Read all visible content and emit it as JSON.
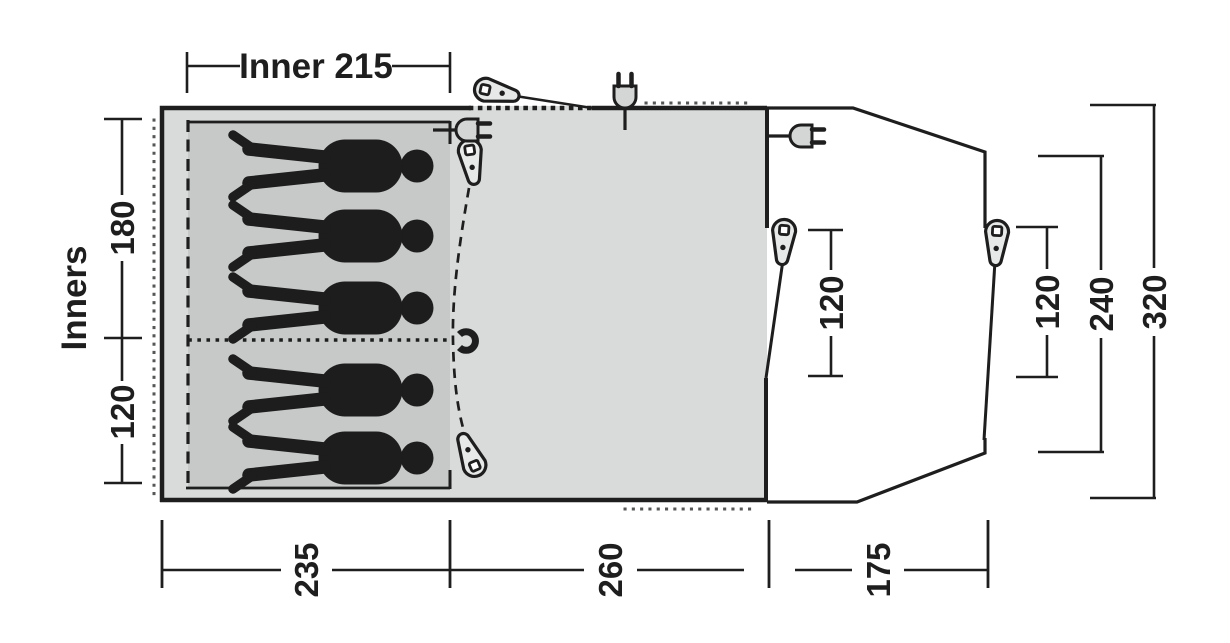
{
  "diagram": {
    "kind": "tent floor plan",
    "labels": {
      "inners": "Inners",
      "inner_width": "Inner 215"
    },
    "dims": {
      "left_top": "180",
      "left_bottom": "120",
      "bottom_left": "235",
      "bottom_middle": "260",
      "bottom_right": "175",
      "porch": "120",
      "right_inner": "120",
      "right_middle": "240",
      "right_outer": "320"
    },
    "icons": {
      "person_icons": 5,
      "tent_peg_icons": 5,
      "power_plug_icons": 3,
      "door_tieback_hook_icons": 1
    },
    "colors": {
      "outline": "#1d1e1d",
      "main_body_fill": "#d9dbda",
      "inner_tent_fill": "#c7c9c8",
      "porch_fill": "#ffffff",
      "hardware_fill": "#e7e9e8"
    }
  }
}
